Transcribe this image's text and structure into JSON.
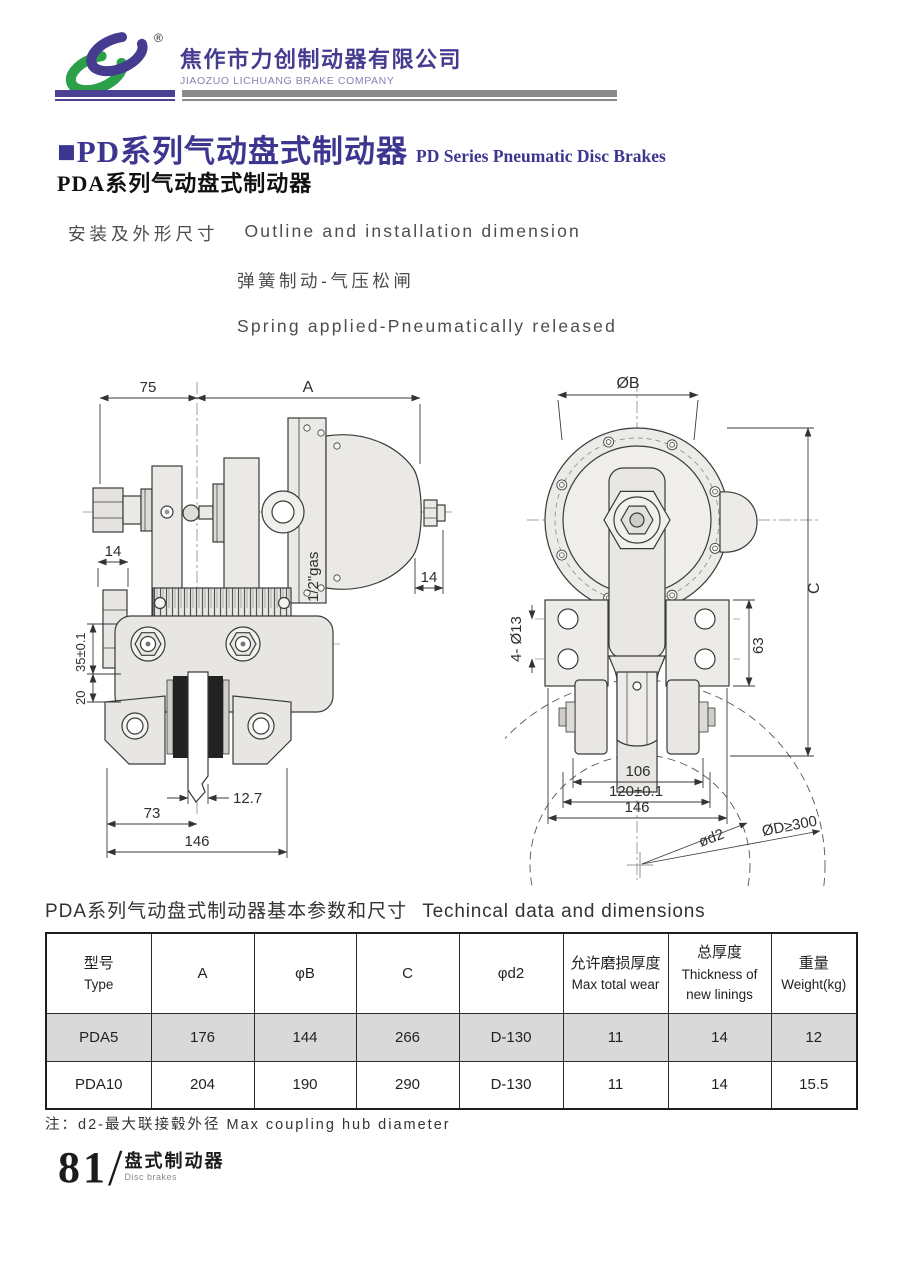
{
  "header": {
    "company_cn": "焦作市力创制动器有限公司",
    "company_en": "JIAOZUO LICHUANG BRAKE COMPANY",
    "registered": "®"
  },
  "title": {
    "cn": "■PD系列气动盘式制动器",
    "en": "PD Series Pneumatic Disc Brakes",
    "sub_cn": "PDA系列气动盘式制动器"
  },
  "intro": {
    "label_cn": "安装及外形尺寸",
    "label_en": "Outline and installation dimension",
    "line2_cn": "弹簧制动-气压松闸",
    "line3_en": "Spring applied-Pneumatically released"
  },
  "drawing_left": {
    "dims": {
      "d75": "75",
      "dA": "A",
      "d14l": "14",
      "d14r": "14",
      "gas": "1/2\"gas",
      "d35": "35±0.1",
      "d20": "20",
      "d127": "12.7",
      "d73": "73",
      "d146": "146"
    }
  },
  "drawing_right": {
    "dims": {
      "dB": "ØB",
      "dC": "C",
      "d4o13": "4- Ø13",
      "d63": "63",
      "d106": "106",
      "d120": "120±0.1",
      "d146": "146",
      "dd2": "ød2",
      "dD": "ØD≥300"
    }
  },
  "table": {
    "title_cn": "PDA系列气动盘式制动器基本参数和尺寸",
    "title_en": "Techincal data and dimensions",
    "headers": [
      [
        "型号",
        "Type"
      ],
      [
        "A"
      ],
      [
        "φB"
      ],
      [
        "C"
      ],
      [
        "φd2"
      ],
      [
        "允许磨损厚度",
        "Max total wear"
      ],
      [
        "总厚度",
        "Thickness of",
        "new linings"
      ],
      [
        "重量",
        "Weight(kg)"
      ]
    ],
    "rows": [
      [
        "PDA5",
        "176",
        "144",
        "266",
        "D-130",
        "11",
        "14",
        "12"
      ],
      [
        "PDA10",
        "204",
        "190",
        "290",
        "D-130",
        "11",
        "14",
        "15.5"
      ]
    ],
    "note": "注：d2-最大联接毂外径  Max coupling hub diameter"
  },
  "footer": {
    "page": "81",
    "slash": "/",
    "cn": "盘式制动器",
    "en": "Disc brakes"
  },
  "colors": {
    "brand_purple": "#453c8f",
    "brand_green": "#2ca048",
    "title_purple": "#3d3690",
    "row_gray": "#d9d9d9"
  }
}
